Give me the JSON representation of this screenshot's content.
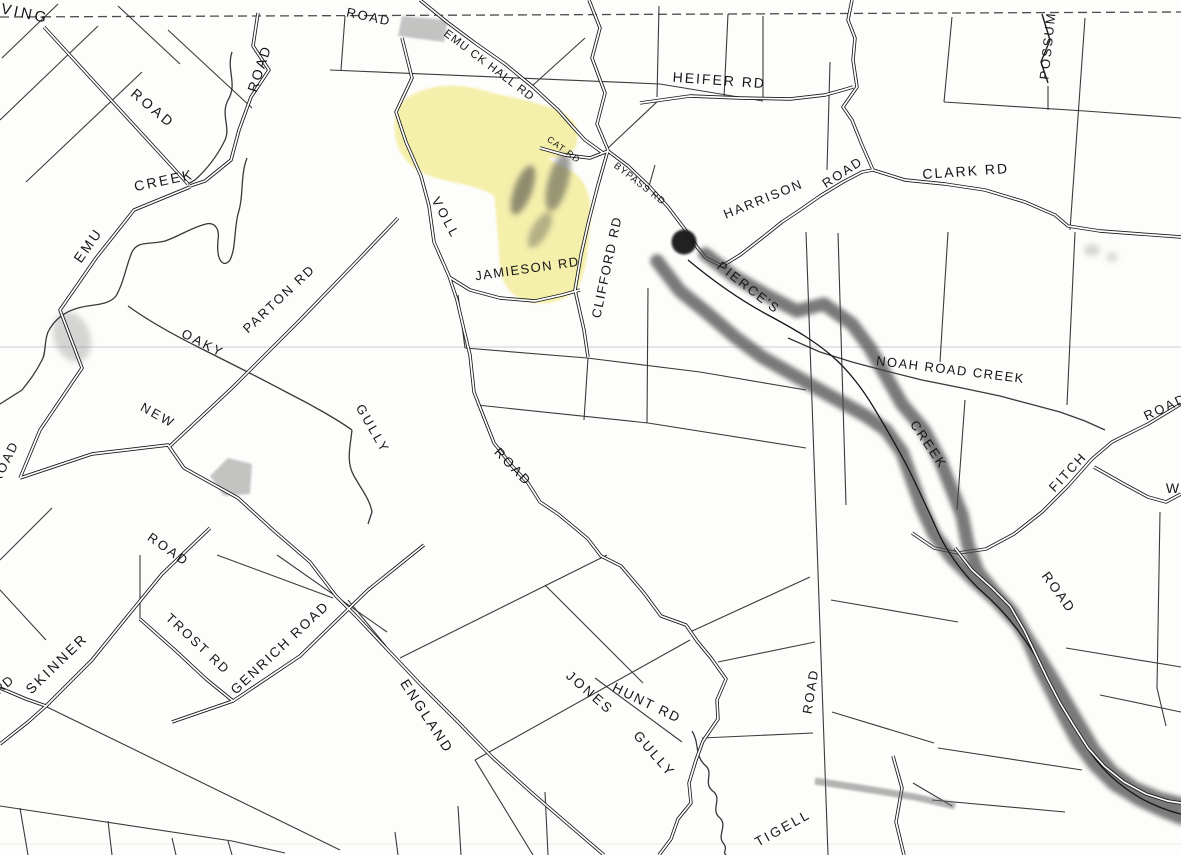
{
  "map": {
    "description_labels_count": 39,
    "colors": {
      "paper": "#fdfdfb",
      "ink": "#1f1f1f",
      "highlight_yellow": "#efe25f",
      "marker_dark": "#474747",
      "parcel_gray": "#b0b0b0"
    }
  },
  "labels": [
    {
      "text": "IRVING",
      "kind": "road"
    },
    {
      "text": "ROAD",
      "kind": "road"
    },
    {
      "text": "ROAD",
      "kind": "road"
    },
    {
      "text": "ROAD",
      "kind": "road"
    },
    {
      "text": "EMU CK HALL RD",
      "kind": "road"
    },
    {
      "text": "HEIFER RD",
      "kind": "road"
    },
    {
      "text": "POSSUM",
      "kind": "road"
    },
    {
      "text": "CLARK RD",
      "kind": "road"
    },
    {
      "text": "HARRISON",
      "kind": "road"
    },
    {
      "text": "ROAD",
      "kind": "road"
    },
    {
      "text": "CAT RD",
      "kind": "road"
    },
    {
      "text": "BYPASS RD",
      "kind": "road"
    },
    {
      "text": "CLIFFORD RD",
      "kind": "road"
    },
    {
      "text": "VOLL",
      "kind": "road"
    },
    {
      "text": "JAMIESON RD",
      "kind": "road"
    },
    {
      "text": "PIERCE'S",
      "kind": "creek"
    },
    {
      "text": "CREEK",
      "kind": "creek"
    },
    {
      "text": "NOAH ROAD CREEK",
      "kind": "creek"
    },
    {
      "text": "FITCH",
      "kind": "road"
    },
    {
      "text": "ROAD",
      "kind": "road"
    },
    {
      "text": "W",
      "kind": "road"
    },
    {
      "text": "PARTON RD",
      "kind": "road"
    },
    {
      "text": "OAKY",
      "kind": "creek"
    },
    {
      "text": "NEW",
      "kind": "road"
    },
    {
      "text": "GULLY",
      "kind": "creek"
    },
    {
      "text": "ROAD",
      "kind": "road"
    },
    {
      "text": "ROAD",
      "kind": "road"
    },
    {
      "text": "ROAD",
      "kind": "road"
    },
    {
      "text": "SKINNER",
      "kind": "road"
    },
    {
      "text": "RD",
      "kind": "road"
    },
    {
      "text": "TROST RD",
      "kind": "road"
    },
    {
      "text": "GENRICH ROAD",
      "kind": "road"
    },
    {
      "text": "ENGLAND",
      "kind": "road"
    },
    {
      "text": "JONES",
      "kind": "creek"
    },
    {
      "text": "HUNT RD",
      "kind": "road"
    },
    {
      "text": "GULLY",
      "kind": "creek"
    },
    {
      "text": "ROAD",
      "kind": "road"
    },
    {
      "text": "TIGELL",
      "kind": "road"
    },
    {
      "text": "ROAD",
      "kind": "road"
    },
    {
      "text": "EMU",
      "kind": "creek"
    },
    {
      "text": "CREEK",
      "kind": "creek"
    }
  ]
}
